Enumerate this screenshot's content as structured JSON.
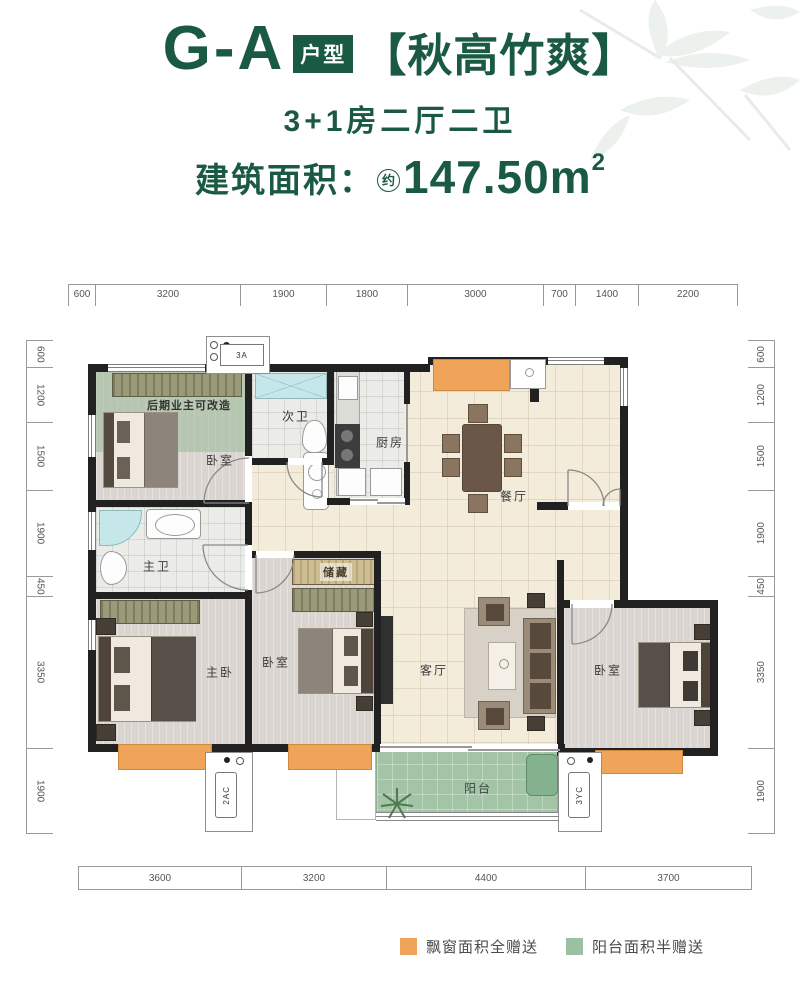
{
  "header": {
    "code": "G-A",
    "badge": "户型",
    "name": "【秋高竹爽】",
    "layout": "3+1房二厅二卫",
    "area_label": "建筑面积：",
    "area_circle": "约",
    "area_value": "147.50m",
    "area_sup": "2"
  },
  "dims": {
    "top": [
      "600",
      "3200",
      "1900",
      "1800",
      "3000",
      "700",
      "1400",
      "2200"
    ],
    "bottom": [
      "3600",
      "3200",
      "4400",
      "3700"
    ],
    "left": [
      "600",
      "1200",
      "1500",
      "1900",
      "450",
      "3350",
      "1900"
    ],
    "right": [
      "600",
      "1200",
      "1500",
      "1900",
      "450",
      "3350",
      "1900"
    ]
  },
  "rooms": {
    "bedroom_tl": "卧室",
    "note_convertible": "后期业主可改造",
    "bath_second": "次卫",
    "kitchen": "厨房",
    "dining": "餐厅",
    "bath_master": "主卫",
    "bedroom_master": "主卧",
    "storage": "储藏",
    "bedroom_mid": "卧室",
    "living": "客厅",
    "bedroom_right": "卧室",
    "balcony": "阳台",
    "ac_top": "3A",
    "ac_left": "2AC",
    "ac_right": "3YC"
  },
  "legend": {
    "bay_window": {
      "label": "飘窗面积全赠送",
      "color": "#efa45a"
    },
    "balcony": {
      "label": "阳台面积半赠送",
      "color": "#9cc0a2"
    }
  },
  "colors": {
    "brand_green": "#1b5a42",
    "bay_orange": "#efa45a",
    "balcony_green": "#a3c4a6",
    "convertible_green": "#98ba98",
    "wall": "#212121"
  }
}
